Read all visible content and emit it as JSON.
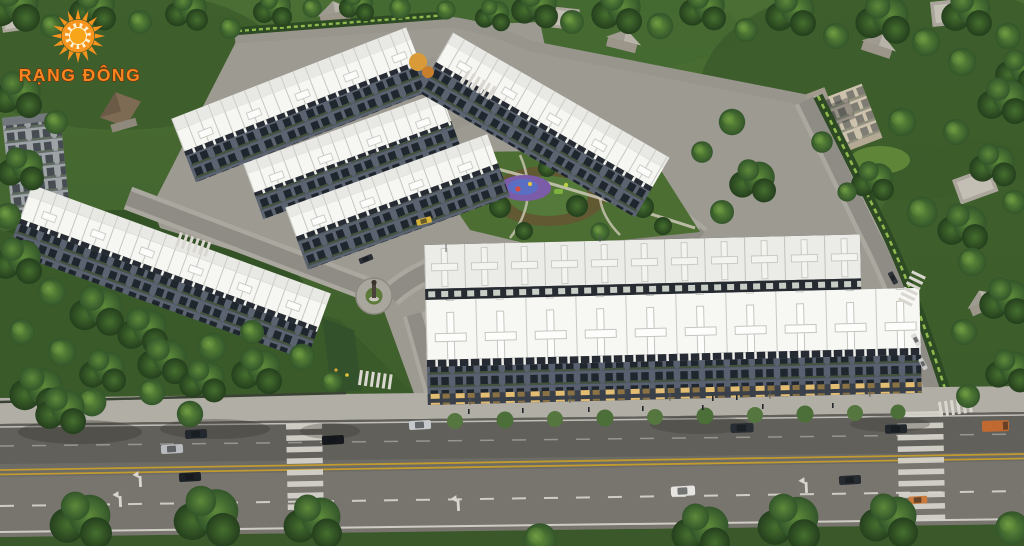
{
  "logo": {
    "brand_name": "RẠNG ĐÔNG",
    "sun_icon": "sun-with-rays-icon",
    "colors": {
      "sun_orange": "#F7941E",
      "sun_core": "#F9A51A",
      "sun_ring_cream": "#FDF2D0",
      "text_fill": "#F6861F",
      "text_outline": "#7A2206"
    }
  },
  "scene": {
    "description": "Aerial 3D render of the Rang Dong residential development: six rows of white-roofed townhouses around a central park with a purple playground, a statue roundabout, light-gray internal streets, dense surrounding tree canopy with existing houses, and a wide main boulevard with yellow center lines, crosswalks and cars along the bottom",
    "palette": {
      "tree_dark": "#2C4A22",
      "tree_mid": "#47702F",
      "tree_bright": "#8CBB52",
      "roof_white": "#F6F6F3",
      "roof_far": "#E8E8E4",
      "facade_gray": "#5B6370",
      "cornice_dark": "#272C34",
      "road_asphalt": "#6D6B66",
      "road_internal": "#8F8C85",
      "sidewalk": "#B1AEA5",
      "lane_yellow": "#C29B2E",
      "marking_white": "#D8D6CE",
      "playground_purple": "#7A5CA8",
      "playground_blue": "#5A6FC4",
      "window_lit": "#E2BD72"
    },
    "counts": {
      "townhouse_rows": 6,
      "cars_visible": 16,
      "crosswalks_main_road": 2
    }
  }
}
